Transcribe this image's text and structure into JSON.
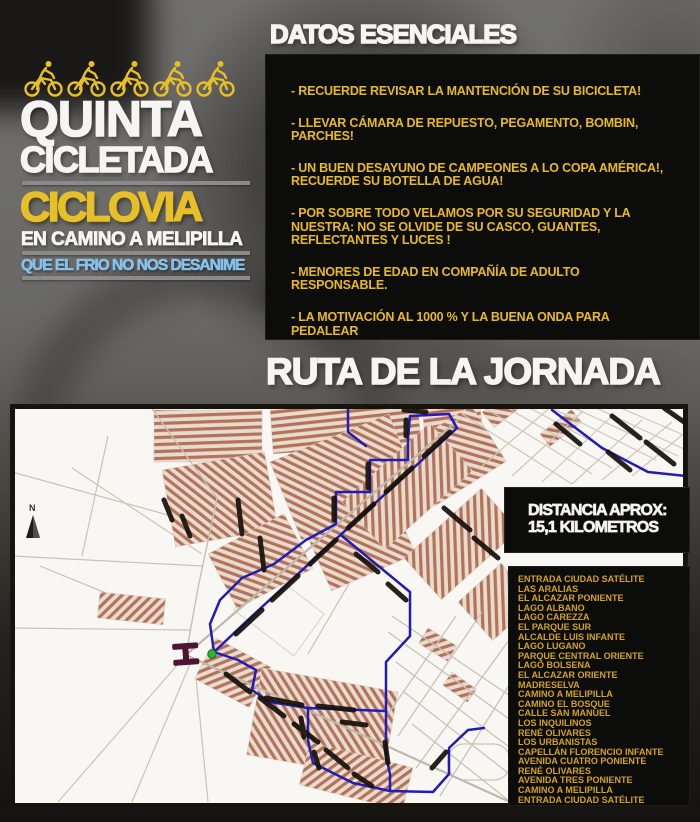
{
  "logo": {
    "title_line1": "QUINTA",
    "title_line2": "CICLETADA",
    "subtitle": "CICLOVIA",
    "route_line": "EN CAMINO A MELIPILLA",
    "motto": "QUE EL FRIO NO NOS DESANIME"
  },
  "essentials": {
    "heading": "DATOS ESENCIALES",
    "items": [
      "- RECUERDE REVISAR LA MANTENCIÓN DE SU BICICLETA!",
      "- LLEVAR CÁMARA DE REPUESTO, PEGAMENTO, BOMBIN, PARCHES!",
      "- UN BUEN DESAYUNO DE CAMPEONES A LO COPA AMÉRICA!, RECUERDE SU BOTELLA DE AGUA!",
      "- POR SOBRE TODO VELAMOS POR SU SEGURIDAD Y LA NUESTRA: NO SE OLVIDE DE SU CASCO, GUANTES, REFLECTANTES Y LUCES !",
      "- MENORES DE EDAD EN COMPAÑÍA DE ADULTO RESPONSABLE.",
      "- LA MOTIVACIÓN AL 1000 % Y LA BUENA ONDA PARA PEDALEAR"
    ]
  },
  "route_section": {
    "heading": "RUTA DE LA JORNADA",
    "distance_label": "DISTANCIA APROX:",
    "distance_value": "15,1 KILOMETROS",
    "north_label": "N",
    "streets": [
      "ENTRADA CIUDAD SATÉLITE",
      "LAS ARALIAS",
      "EL ALCAZAR PONIENTE",
      "LAGO ALBANO",
      "LAGO CAREZZA",
      "EL PARQUE SUR",
      "ALCALDE  LUIS INFANTE",
      "LAGO LUGANO",
      "PARQUE CENTRAL ORIENTE",
      "LAGO BOLSENA",
      "EL ALCAZAR ORIENTE",
      "MADRESELVA",
      "CAMINO A MELIPILLA",
      "CAMINO EL BOSQUE",
      "CALLE SAN MANUEL",
      "LOS INQUILINOS",
      "RENÉ OLIVARES",
      "LOS URBANISTAS",
      "CAPELLÁN FLORENCIO INFANTE",
      "AVENIDA CUATRO PONIENTE",
      "RENÉ OLIVARES",
      "AVENIDA TRES PONIENTE",
      "CAMINO A MELIPILLA",
      "ENTRADA CIUDAD SATÉLITE"
    ]
  },
  "colors": {
    "accent_yellow": "#e7bf27",
    "list_yellow": "#d4a31d",
    "motto_blue": "#85c2e9",
    "route_blue": "#221cb4",
    "urban_brown": "#b2735a"
  }
}
